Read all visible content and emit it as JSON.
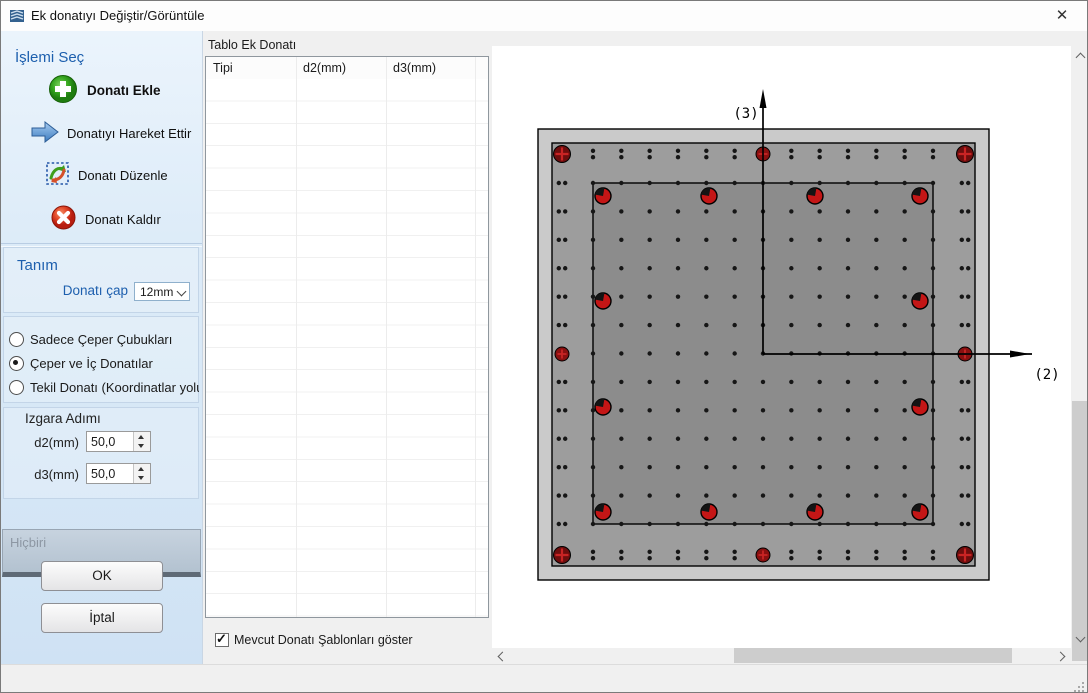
{
  "window": {
    "title": "Ek donatıyı Değiştir/Görüntüle",
    "close_glyph": "✕"
  },
  "sidebar": {
    "section1_title": "İşlemi Seç",
    "actions": [
      {
        "label": "Donatı Ekle",
        "icon": "add-rebar-icon"
      },
      {
        "label": "Donatıyı Hareket Ettir",
        "icon": "move-rebar-icon"
      },
      {
        "label": "Donatı Düzenle",
        "icon": "edit-rebar-icon"
      },
      {
        "label": "Donatı Kaldır",
        "icon": "remove-rebar-icon"
      }
    ],
    "section2_title": "Tanım",
    "diameter_label": "Donatı çap",
    "diameter_value": "12mm",
    "radio_options": [
      {
        "label": "Sadece Çeper Çubukları",
        "selected": false
      },
      {
        "label": "Çeper ve İç Donatılar",
        "selected": true
      },
      {
        "label": "Tekil Donatı (Koordinatlar yoluyla",
        "selected": false
      }
    ],
    "grid_title": "Izgara Adımı",
    "d2_label": "d2(mm)",
    "d2_value": "50,0",
    "d3_label": "d3(mm)",
    "d3_value": "50,0",
    "none_label": "Hiçbiri",
    "ok_label": "OK",
    "cancel_label": "İptal"
  },
  "table_panel": {
    "title": "Tablo Ek Donatı",
    "columns": [
      "Tipi",
      "d2(mm)",
      "d3(mm)"
    ],
    "rows": [],
    "checkbox_label": "Mevcut Donatı Şablonları göster",
    "checkbox_checked": true
  },
  "drawing": {
    "axis_v_label": "(3)",
    "axis_h_label": "(2)",
    "colors": {
      "outer": "#cacaca",
      "band": "#9d9d9d",
      "core": "#8c8c8c",
      "bar_bright": "#c41616",
      "bar_dark": "#6e0d0d",
      "cross": "#c92424",
      "dot": "#161616"
    },
    "outer_rect": [
      537,
      128,
      451,
      451
    ],
    "band_rect": [
      551,
      142,
      423,
      423
    ],
    "core_rect": [
      592,
      182,
      340,
      341
    ],
    "grid_n": 13,
    "perimeter": {
      "left_x": 561,
      "right_x": 964,
      "top_y": 153,
      "bottom_y": 554,
      "pair_offset": 3.2
    },
    "axis": {
      "origin": [
        762,
        353
      ],
      "v_top": 96,
      "h_right": 1031,
      "v_label_pos": [
        745,
        117
      ],
      "h_label_pos": [
        1046,
        378
      ]
    },
    "corner_bars": [
      [
        561,
        153
      ],
      [
        964,
        153
      ],
      [
        561,
        554
      ],
      [
        964,
        554
      ]
    ],
    "mid_bars": [
      [
        762,
        153
      ],
      [
        762,
        554
      ],
      [
        561,
        353
      ],
      [
        964,
        353
      ]
    ],
    "core_bars": [
      [
        602,
        195
      ],
      [
        708,
        195
      ],
      [
        814,
        195
      ],
      [
        919,
        195
      ],
      [
        602,
        300
      ],
      [
        919,
        300
      ],
      [
        602,
        406
      ],
      [
        919,
        406
      ],
      [
        602,
        511
      ],
      [
        708,
        511
      ],
      [
        814,
        511
      ],
      [
        919,
        511
      ]
    ]
  }
}
